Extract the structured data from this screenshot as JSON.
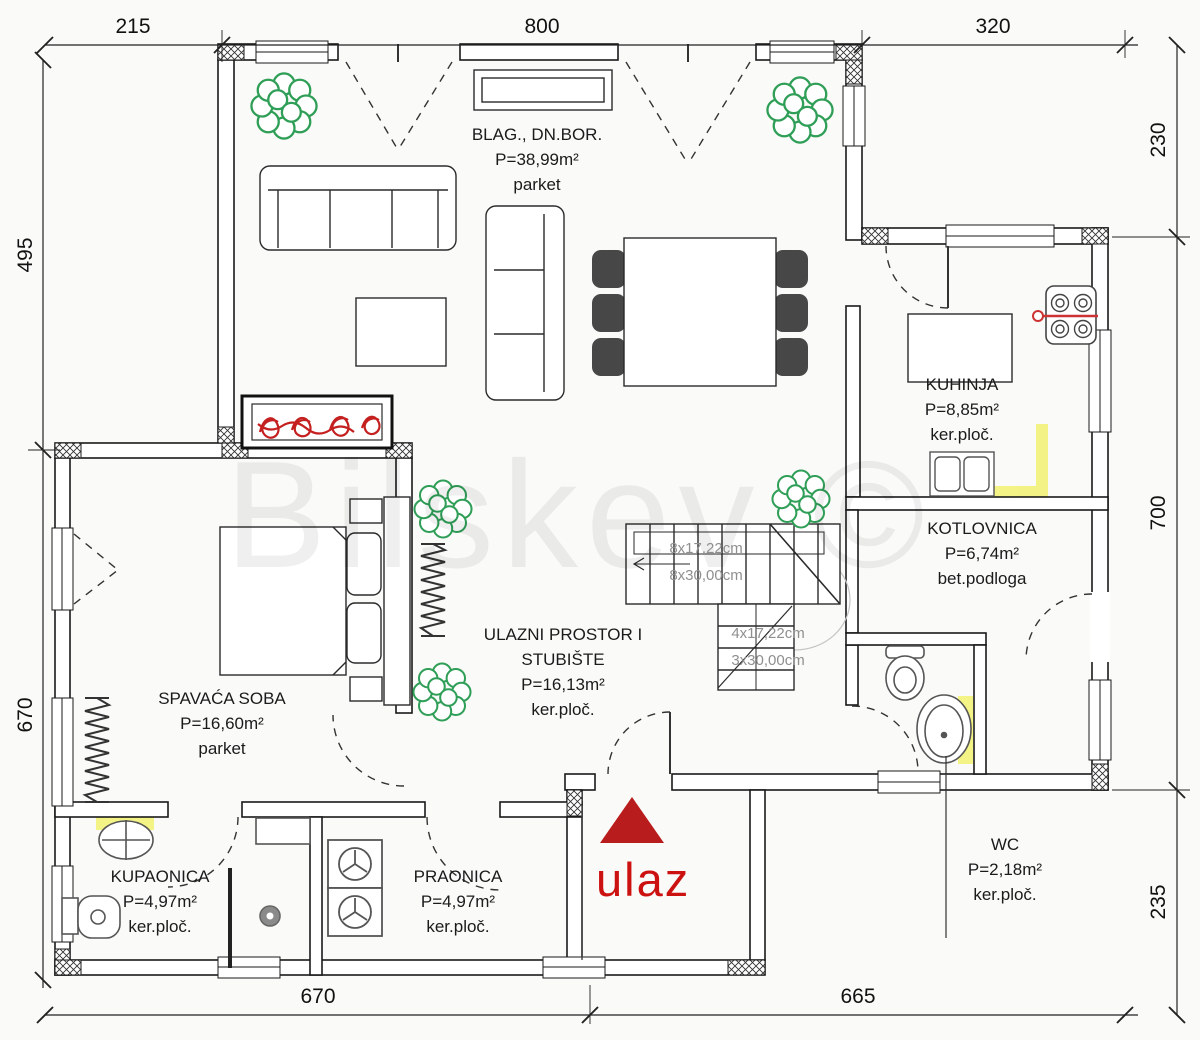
{
  "watermark": "Bilskev ©",
  "entrance": {
    "label": "ulaz"
  },
  "rooms": [
    {
      "id": "living",
      "name": "BLAG., DN.BOR.",
      "area": "P=38,99m²",
      "floor": "parket"
    },
    {
      "id": "kitchen",
      "name": "KUHINJA",
      "area": "P=8,85m²",
      "floor": "ker.ploč."
    },
    {
      "id": "boiler",
      "name": "KOTLOVNICA",
      "area": "P=6,74m²",
      "floor": "bet.podloga"
    },
    {
      "id": "hall",
      "name": "ULAZNI PROSTOR I",
      "name2": "STUBIŠTE",
      "area": "P=16,13m²",
      "floor": "ker.ploč."
    },
    {
      "id": "bedroom",
      "name": "SPAVAĆA SOBA",
      "area": "P=16,60m²",
      "floor": "parket"
    },
    {
      "id": "bathroom",
      "name": "KUPAONICA",
      "area": "P=4,97m²",
      "floor": "ker.ploč."
    },
    {
      "id": "laundry",
      "name": "PRAONICA",
      "area": "P=4,97m²",
      "floor": "ker.ploč."
    },
    {
      "id": "wc",
      "name": "WC",
      "area": "P=2,18m²",
      "floor": "ker.ploč."
    }
  ],
  "stairs": {
    "upper": [
      "8x17,22cm",
      "8x30,00cm"
    ],
    "lower": [
      "4x17,22cm",
      "3x30,00cm"
    ]
  },
  "dimensions": {
    "top": [
      "215",
      "800",
      "320"
    ],
    "left": [
      "495",
      "670"
    ],
    "right": [
      "230",
      "700",
      "235"
    ],
    "bottom": [
      "670",
      "665"
    ]
  },
  "colors": {
    "accent_red": "#cc1111",
    "highlight_yellow": "#f3f37c",
    "tree_green": "#2f9e57",
    "wall_line": "#1a1a1a",
    "stair_text": "#8f8f8f"
  }
}
